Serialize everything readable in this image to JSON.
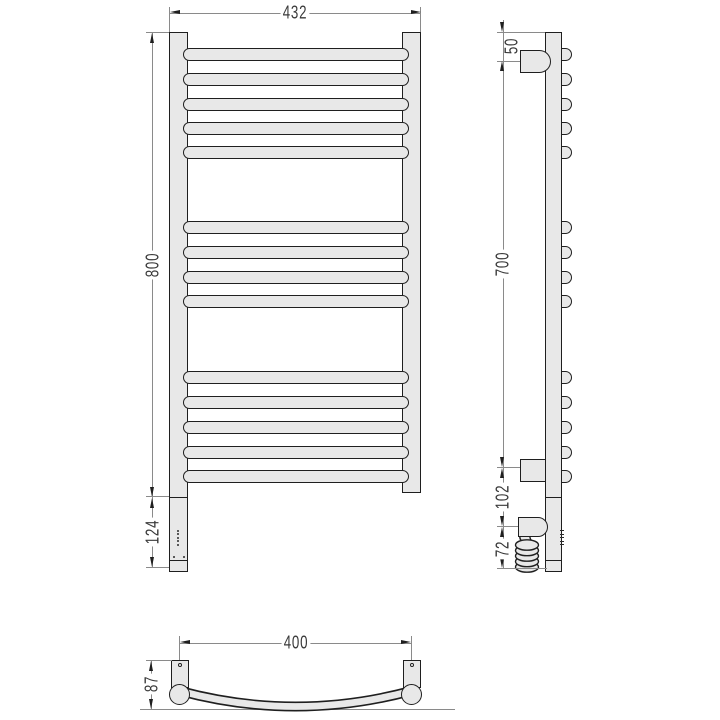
{
  "title": "Heated towel rail technical drawing",
  "dimensions": {
    "front_width": "432",
    "front_height": "800",
    "front_heater_height": "124",
    "side_top_offset": "50",
    "side_bracket_span": "700",
    "side_bottom_offset": "102",
    "side_cable_length": "72",
    "bottom_width": "400",
    "bottom_depth": "87"
  },
  "drawing": {
    "colors": {
      "outline": "#1f1f1f",
      "fill": "#e8e8e8",
      "dim_line": "#8a8a8a",
      "text": "#3a3a3a",
      "background": "#ffffff"
    },
    "front_bars_y": [
      47.5,
      72.5,
      97.5,
      121.5,
      145.5,
      220.5,
      245.5,
      270.5,
      294.5,
      370.5,
      395.5,
      420.5,
      445.5,
      469.5
    ],
    "bar_height": 13,
    "bar_groups": [
      5,
      4,
      5
    ],
    "led_dots_y": [
      529.5,
      533,
      536.5,
      540,
      543.5
    ],
    "coil_loops": 5
  }
}
